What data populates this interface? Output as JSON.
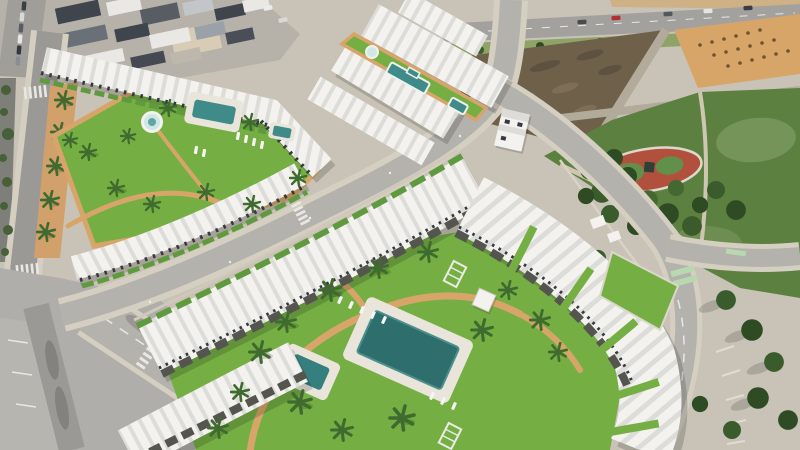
{
  "image": {
    "kind": "aerial-photograph",
    "subject": "Aerial render of a new-build white residential development with pools, lawns, palm trees, a public park and surrounding roads",
    "width_px": 800,
    "height_px": 450
  },
  "palette": {
    "ground": "#c9c3b7",
    "road": "#b4b2ac",
    "road_old": "#9b9995",
    "sidewalk": "#d5cfc2",
    "pavement": "#b0aeaa",
    "grass": "#75af44",
    "park_green": "#5c8040",
    "tree_dark": "#2f4b24",
    "tree_mid": "#3a5c2d",
    "tree_light": "#44682f",
    "palm_green": "#3f6b2f",
    "pool_water": "#2e6f6e",
    "pool_water_light": "#3e8b89",
    "pool_deck": "#e9e5da",
    "spa_water": "#cfe8e6",
    "path_tan": "#d7a569",
    "strip_tan": "#d2a06a",
    "building_white": "#f3f2ef",
    "roof_rib": "#dcdcd8",
    "pergola": "#55554f",
    "window_dark": "#353a40",
    "urban_block": "#b6b2aa",
    "dirt_dark": "#6f604a",
    "dirt_orange": "#d8a569",
    "playground_red": "#b2503e",
    "playground_green": "#628f4a",
    "car_red": "#b03230",
    "wall_tan": "#cfb186",
    "verge_green": "#8fa268",
    "bike_lane": "#b8d8b0",
    "marking_white": "#e9e7e3",
    "hedge": "#47603a",
    "lawn_patch": "#74945a"
  },
  "scene": {
    "existing_town": {
      "name": "existing-town",
      "blocks": 14,
      "parked_cars": 6
    },
    "roads": {
      "top_road": "arterial road with traffic",
      "left_road": "palm-lined street with zebra crossings",
      "avenue": "central avenue between complexes",
      "perimeter_road": "curved road with cycle crossing and lane arrow",
      "wide_road": "wide avenue with tree shadows and crosswalk"
    },
    "vehicles": {
      "red_car": 1,
      "grey_cars": 4,
      "parked_cars": 6
    },
    "vacant_lots": {
      "dark_plot": "ploughed earth plot",
      "orange_plot": "sandy plot with shrub rows"
    },
    "park": {
      "features": [
        "red playground oval",
        "pine trees",
        "lawn patches",
        "paths",
        "utility buildings"
      ]
    },
    "complex_upper_left": {
      "rows": 3,
      "pools": 2,
      "spa": 1,
      "sun_loungers": 6,
      "palms": 10
    },
    "complex_upper_middle": {
      "rows": 4,
      "green_strip_pools": 2,
      "spa": 1
    },
    "detached_house": 1,
    "complex_lower": {
      "rows": 3,
      "main_pool": 1,
      "kids_pool": 1,
      "pavilion": 1,
      "pergola_frames": 2,
      "sun_loungers": 8,
      "palms": 14
    }
  }
}
